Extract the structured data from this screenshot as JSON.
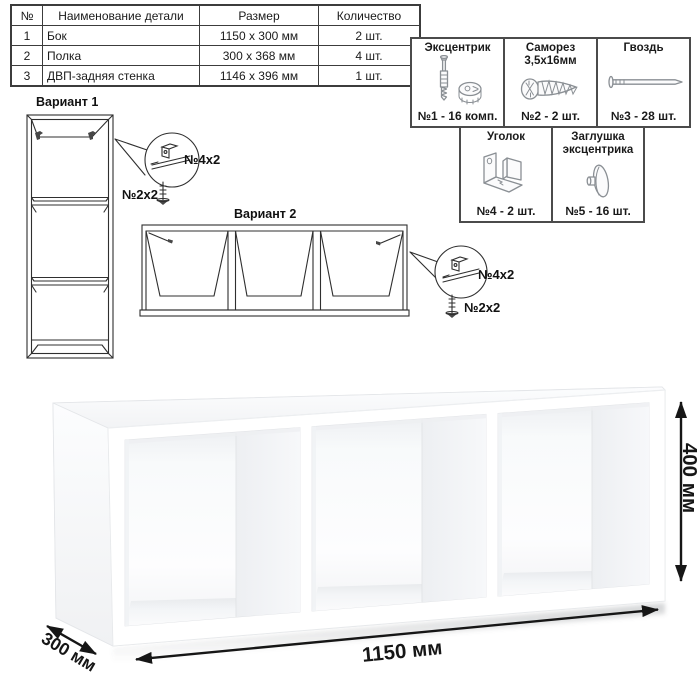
{
  "parts_table": {
    "headers": [
      "№",
      "Наименование детали",
      "Размер",
      "Количество"
    ],
    "rows": [
      {
        "num": "1",
        "name": "Бок",
        "size": "1150 х 300 мм",
        "qty": "2 шт."
      },
      {
        "num": "2",
        "name": "Полка",
        "size": "300 х 368 мм",
        "qty": "4 шт."
      },
      {
        "num": "3",
        "name": "ДВП-задняя стенка",
        "size": "1146 х 396 мм",
        "qty": "1 шт."
      }
    ]
  },
  "hardware_box": {
    "row1": [
      {
        "title": "Эксцентрик",
        "icon": "eccentric-cam-and-dowel-icon",
        "qty": "№1 - 16 комп."
      },
      {
        "title": "Саморез 3,5х16мм",
        "icon": "screw-icon",
        "qty": "№2 - 2 шт."
      },
      {
        "title": "Гвоздь",
        "icon": "nail-icon",
        "qty": "№3 - 28 шт."
      }
    ],
    "row2": [
      {
        "title": "Уголок",
        "icon": "corner-bracket-icon",
        "qty": "№4 - 2 шт."
      },
      {
        "title": "Заглушка эксцентрика",
        "icon": "cam-cap-icon",
        "qty": "№5 - 16 шт."
      }
    ]
  },
  "variant1": {
    "title": "Вариант 1",
    "bracket_label": "№4х2",
    "screw_label": "№2х2"
  },
  "variant2": {
    "title": "Вариант 2",
    "bracket_label": "№4х2",
    "screw_label": "№2х2"
  },
  "dimensions": {
    "width": "1150 мм",
    "depth": "300 мм",
    "height": "400 мм"
  },
  "colors": {
    "line_art": "#2f2f2f",
    "dimension_arrows": "#161616",
    "hardware_icon": "#8a8f94",
    "table_border": "#3c3c3c"
  }
}
